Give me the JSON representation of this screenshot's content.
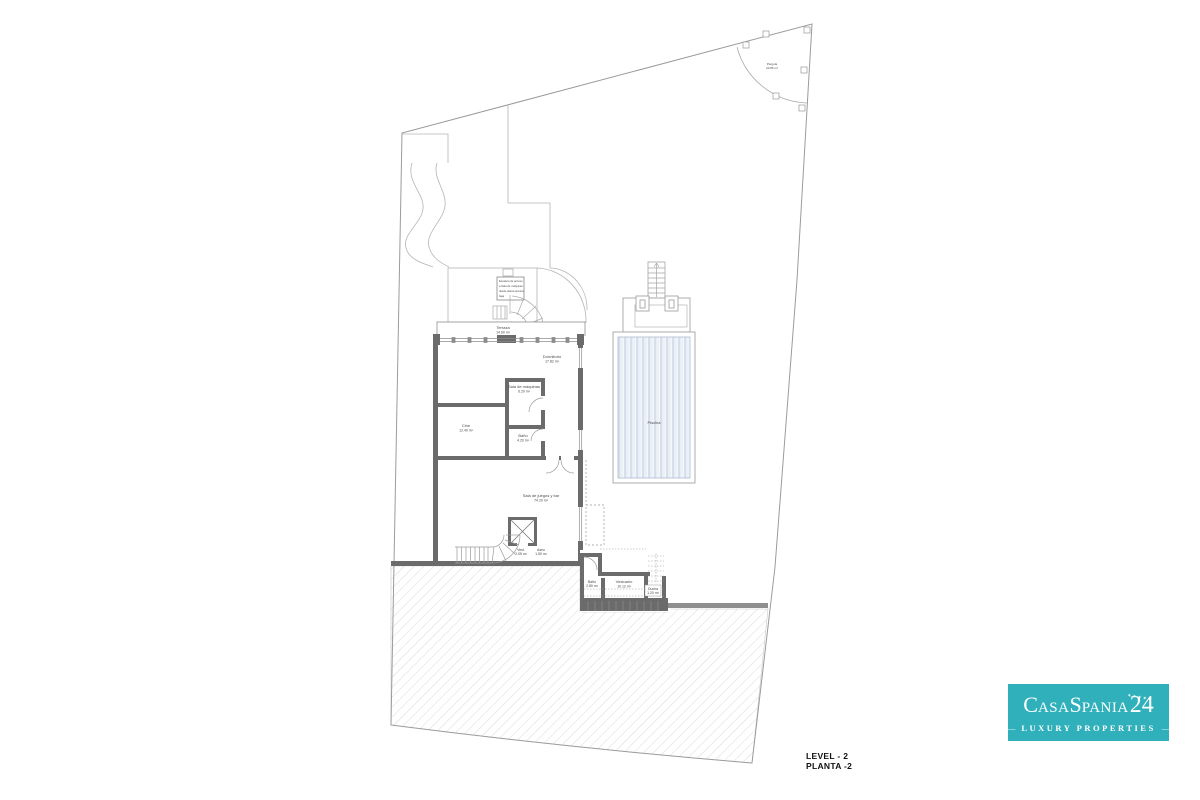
{
  "plan": {
    "rooms": {
      "terraza": {
        "name": "Terraza",
        "area": "14.60 m²"
      },
      "dormitorio": {
        "name": "Dormitorio",
        "area": "17.82 m²"
      },
      "sala_maquinas": {
        "name": "Sala de máquinas",
        "area": "6.20 m²"
      },
      "cine": {
        "name": "Cine",
        "area": "12.40 m²"
      },
      "bano": {
        "name": "Baño",
        "area": "4.20 m²"
      },
      "sala_juegos": {
        "name": "Sala de juegos y bar",
        "area": "74.20 m²"
      },
      "vestibulo": {
        "name": "Vest.",
        "area": "2.05 m²"
      },
      "aseo": {
        "name": "Aseo",
        "area": "1.50 m²"
      },
      "bano_exterior": {
        "name": "Baño",
        "area": "2.80 m²"
      },
      "vestuario": {
        "name": "Vestuario",
        "area": "10.12 m²"
      },
      "ducha": {
        "name": "Ducha",
        "area": "1.20 m²"
      },
      "piscina": {
        "name": "Piscina"
      },
      "pergola": {
        "name": "Pérgola",
        "area": "20.86 m²"
      }
    },
    "note": {
      "line1": "Escalera de acceso",
      "line2": "a Sala de máquinas",
      "line3": "desde planta piscina",
      "line4": "baja"
    }
  },
  "footer": {
    "level_en": "LEVEL - 2",
    "level_es": "PLANTA -2"
  },
  "logo": {
    "part1": "C",
    "part2": "asa",
    "part3": "S",
    "part4": "pania",
    "number": "24",
    "stars": "✶✶✶✶✶",
    "dash": "—",
    "tagline": "LUXURY PROPERTIES"
  },
  "colors": {
    "wall": "#6b6b6b",
    "thin_line": "#9b9b9b",
    "water_stripe": "#d6e0ed",
    "hatch": "#dadada",
    "logo_teal": "#2fb0ba",
    "logo_text": "#ffffff"
  }
}
